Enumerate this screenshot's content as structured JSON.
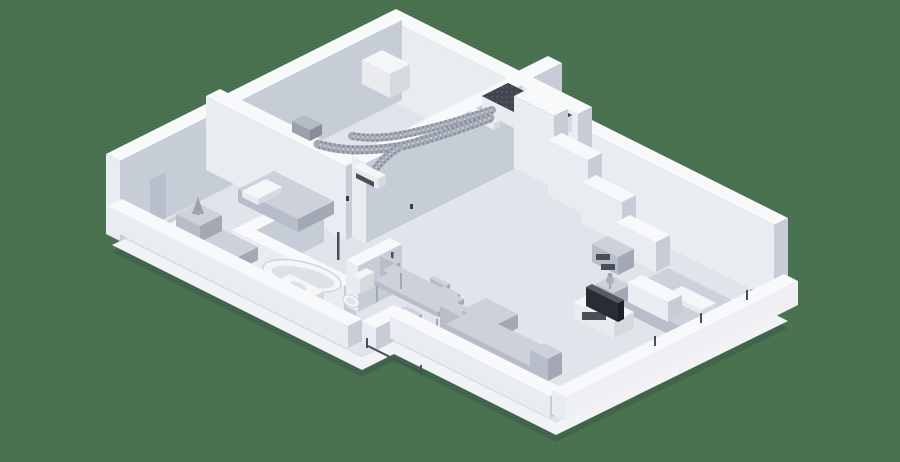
{
  "image": {
    "type": "3d-isometric-apartment-floor-plan",
    "description": "Isometric 3D cutaway render of an apartment with a ducted ventilation system: a ventilation unit with a dark perforated top sits on the interior walls, corrugated flexible ducts run along wall tops to white wall-mounted air diffusers. Rooms: left bedroom with two single beds, bathroom with bathtub, vanity and toilet, dining area with table and four chairs, living room with corner sofa, TV stand and TV, and right bedroom with double bed, nightstands, lamps and a media shelf.",
    "background_color": "#4a7150"
  },
  "palette": {
    "bg": "#4a7150",
    "shadow": "#40654a",
    "floor": "#e1e4ea",
    "floorSide": "#f2f3f6",
    "wallTop": "#f8f9fb",
    "wallSW": "#e9ecf1",
    "wallSE": "#c6cdd7",
    "recess": "#b8bfca",
    "furnTop": "#ccd1da",
    "furnSW": "#b8bec9",
    "furnSE": "#a2a9b5",
    "whiteTop": "#f5f6f8",
    "whiteSW": "#e9ebef",
    "whiteSE": "#d6dade",
    "duct": "#a4abb6",
    "ductDark": "#70767f",
    "ductLight": "#cdd2d9",
    "ductTop": "#b6bcc6",
    "ductSW": "#9aa1ac",
    "ductSE": "#878e99",
    "dark": "#3b3f46",
    "hvacTop": "#42464e",
    "screen": "#282c33",
    "slot": "#4a4e55",
    "basin": "#dde2e8",
    "tubRim": "#cfd5dc",
    "lampShade": "#9ba2ae",
    "lampBody": "#aab1bc"
  },
  "scene": {
    "rooms": [
      {
        "name": "bedroom-left",
        "furniture": [
          "single-bed",
          "single-bed",
          "pillow",
          "pillow",
          "nightstand",
          "table-lamp"
        ]
      },
      {
        "name": "bathroom",
        "furniture": [
          "bathtub",
          "vanity-sink",
          "toilet"
        ]
      },
      {
        "name": "dining-area",
        "furniture": [
          "dining-table",
          "chair",
          "chair",
          "chair",
          "chair"
        ]
      },
      {
        "name": "living-room",
        "furniture": [
          "corner-sofa",
          "tv-stand",
          "tv"
        ]
      },
      {
        "name": "bedroom-right",
        "furniture": [
          "double-bed",
          "pillow",
          "pillow",
          "nightstand",
          "nightstand",
          "table-lamp",
          "table-lamp",
          "media-shelf"
        ]
      }
    ],
    "hvac": {
      "unit": "ventilation-unit",
      "ducts": [
        "flex-duct-main",
        "flex-duct-upper",
        "flex-duct-branch-left",
        "flex-duct-branch-right"
      ],
      "outlets": [
        "duct-terminal",
        "wall-diffuser-hall",
        "wall-diffuser-living"
      ]
    },
    "details": [
      "wall-switch",
      "wall-switch",
      "wall-switch",
      "door-opening",
      "door-frame",
      "balcony-door-frame",
      "window-frame"
    ]
  }
}
